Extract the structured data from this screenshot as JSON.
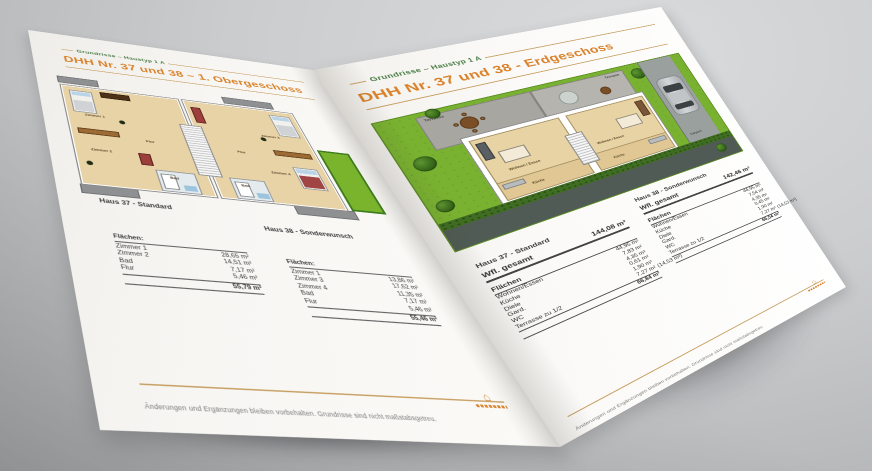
{
  "colors": {
    "accent_green": "#4a7c45",
    "accent_orange": "#d9822b",
    "rule_tan": "#c8a063",
    "lawn_green": "#79b230",
    "floor_beige": "#e8d3a6",
    "studio_gray": "#c0c1c3"
  },
  "left_page": {
    "eyebrow": "Grundrisse – Haustyp 1 A",
    "title": "DHH Nr. 37 und 38 – 1. Obergeschoss",
    "plan": {
      "house37_label": "Haus 37 - Standard",
      "house38_label": "Haus 38 - Sonderwunsch",
      "rooms_h37": {
        "z1": "Zimmer 1",
        "z2": "Zimmer 2",
        "flur": "Flur",
        "bad": "Bad"
      },
      "rooms_h38": {
        "z3": "Zimmer 3",
        "z4": "Zimmer 4",
        "flur": "Flur",
        "bad": "Bad"
      }
    },
    "table_h37": {
      "title": "Flächen:",
      "rows": [
        {
          "label": "Zimmer 1",
          "value": "28,65 m²"
        },
        {
          "label": "Zimmer 2",
          "value": "14,51 m²"
        },
        {
          "label": "Bad",
          "value": "7,17 m²"
        },
        {
          "label": "Flur",
          "value": "5,46 m²"
        }
      ],
      "total": "55,79 m²"
    },
    "table_h38": {
      "title": "Flächen:",
      "rows": [
        {
          "label": "Zimmer 1",
          "value": "13,86 m²"
        },
        {
          "label": "Zimmer 3",
          "value": "17,62 m²"
        },
        {
          "label": "Zimmer 4",
          "value": "11,35 m²"
        },
        {
          "label": "Bad",
          "value": "7,17 m²"
        },
        {
          "label": "Flur",
          "value": "5,46 m²"
        }
      ],
      "total": "55,46 m²"
    },
    "footer_note": "Änderungen und Ergänzungen bleiben vorbehalten. Grundrisse sind nicht maßstabsgetreu."
  },
  "right_page": {
    "eyebrow": "Grundrisse – Haustyp 1 A",
    "title": "DHH Nr. 37 und 38 - Erdgeschoss",
    "plan": {
      "terrasse_left": "Terrasse",
      "terrasse_right": "Terrasse",
      "wohnen_left": "Wohnen / Essen",
      "wohnen_right": "Wohnen / Essen",
      "kueche_left": "Küche",
      "kueche_right": "Küche",
      "carport": "Carport"
    },
    "house37": {
      "label": "Haus 37 - Standard",
      "wfl_label": "Wfl. gesamt",
      "wfl_value": "144,08 m²",
      "table_title": "Flächen",
      "rows": [
        {
          "label": "Wohnen/Essen",
          "value": "44,95 m²"
        },
        {
          "label": "Küche",
          "value": "7,83 m²"
        },
        {
          "label": "Diele",
          "value": "4,35 m²"
        },
        {
          "label": "Gard.",
          "value": "0,61 m²"
        },
        {
          "label": "WC",
          "value": "1,90 m²"
        },
        {
          "label": "Terrasse zu 1/2",
          "value": "7,27 m²",
          "extra": "(14,53 m²)"
        }
      ],
      "total": "66,84 m²"
    },
    "house38": {
      "label": "Haus 38 - Sonderwunsch",
      "wfl_label": "Wfl. gesamt",
      "wfl_value": "142,46 m²",
      "table_title": "Flächen",
      "rows": [
        {
          "label": "Wohnen/Essen",
          "value": "44,95 m²"
        },
        {
          "label": "Küche",
          "value": "7,54 m²"
        },
        {
          "label": "Diele",
          "value": "4,35 m²"
        },
        {
          "label": "Gard.",
          "value": "0,45 m²"
        },
        {
          "label": "WC",
          "value": "1,90 m²"
        },
        {
          "label": "Terrasse zu 1/2",
          "value": "7,27 m²",
          "extra": "(14,53 m²)"
        }
      ],
      "total": "66,54 m²"
    },
    "footer_note": "Änderungen und Ergänzungen bleiben vorbehalten. Grundrisse sind nicht maßstabsgetreu."
  }
}
